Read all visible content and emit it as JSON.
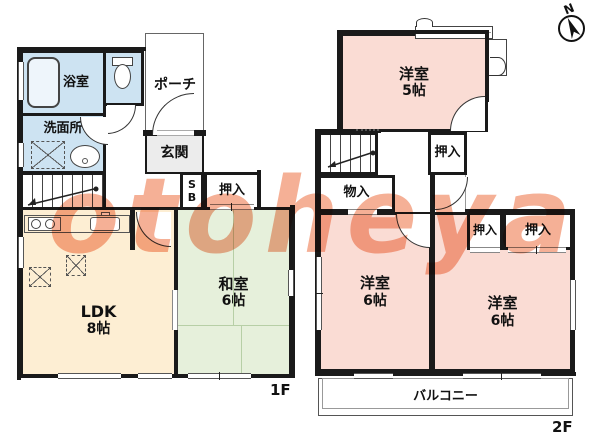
{
  "watermark_text": "otoheya",
  "compass_label": "N",
  "colors": {
    "wall": "#1a1a1a",
    "wet_area_blue": "#cde3f2",
    "ldk_cream": "#fdeed3",
    "tatami_green": "#e6f0db",
    "bedroom_pink": "#fadcd4",
    "watermark_orange": "#f4a284"
  },
  "floor1": {
    "floor_label": "1F",
    "bath": "浴室",
    "washroom": "洗面所",
    "porch": "ポーチ",
    "genkan": "玄関",
    "shoe_box": "SB",
    "closet": "押入",
    "ldk_name": "LDK",
    "ldk_size": "8帖",
    "washitsu_name": "和室",
    "washitsu_size": "6帖"
  },
  "floor2": {
    "floor_label": "2F",
    "bedroom5_name": "洋室",
    "bedroom5_size": "5帖",
    "closet_upper": "押入",
    "storage": "物入",
    "closet_left": "押入",
    "closet_right": "押入",
    "bedroom6l_name": "洋室",
    "bedroom6l_size": "6帖",
    "bedroom6r_name": "洋室",
    "bedroom6r_size": "6帖",
    "balcony": "バルコニー"
  }
}
